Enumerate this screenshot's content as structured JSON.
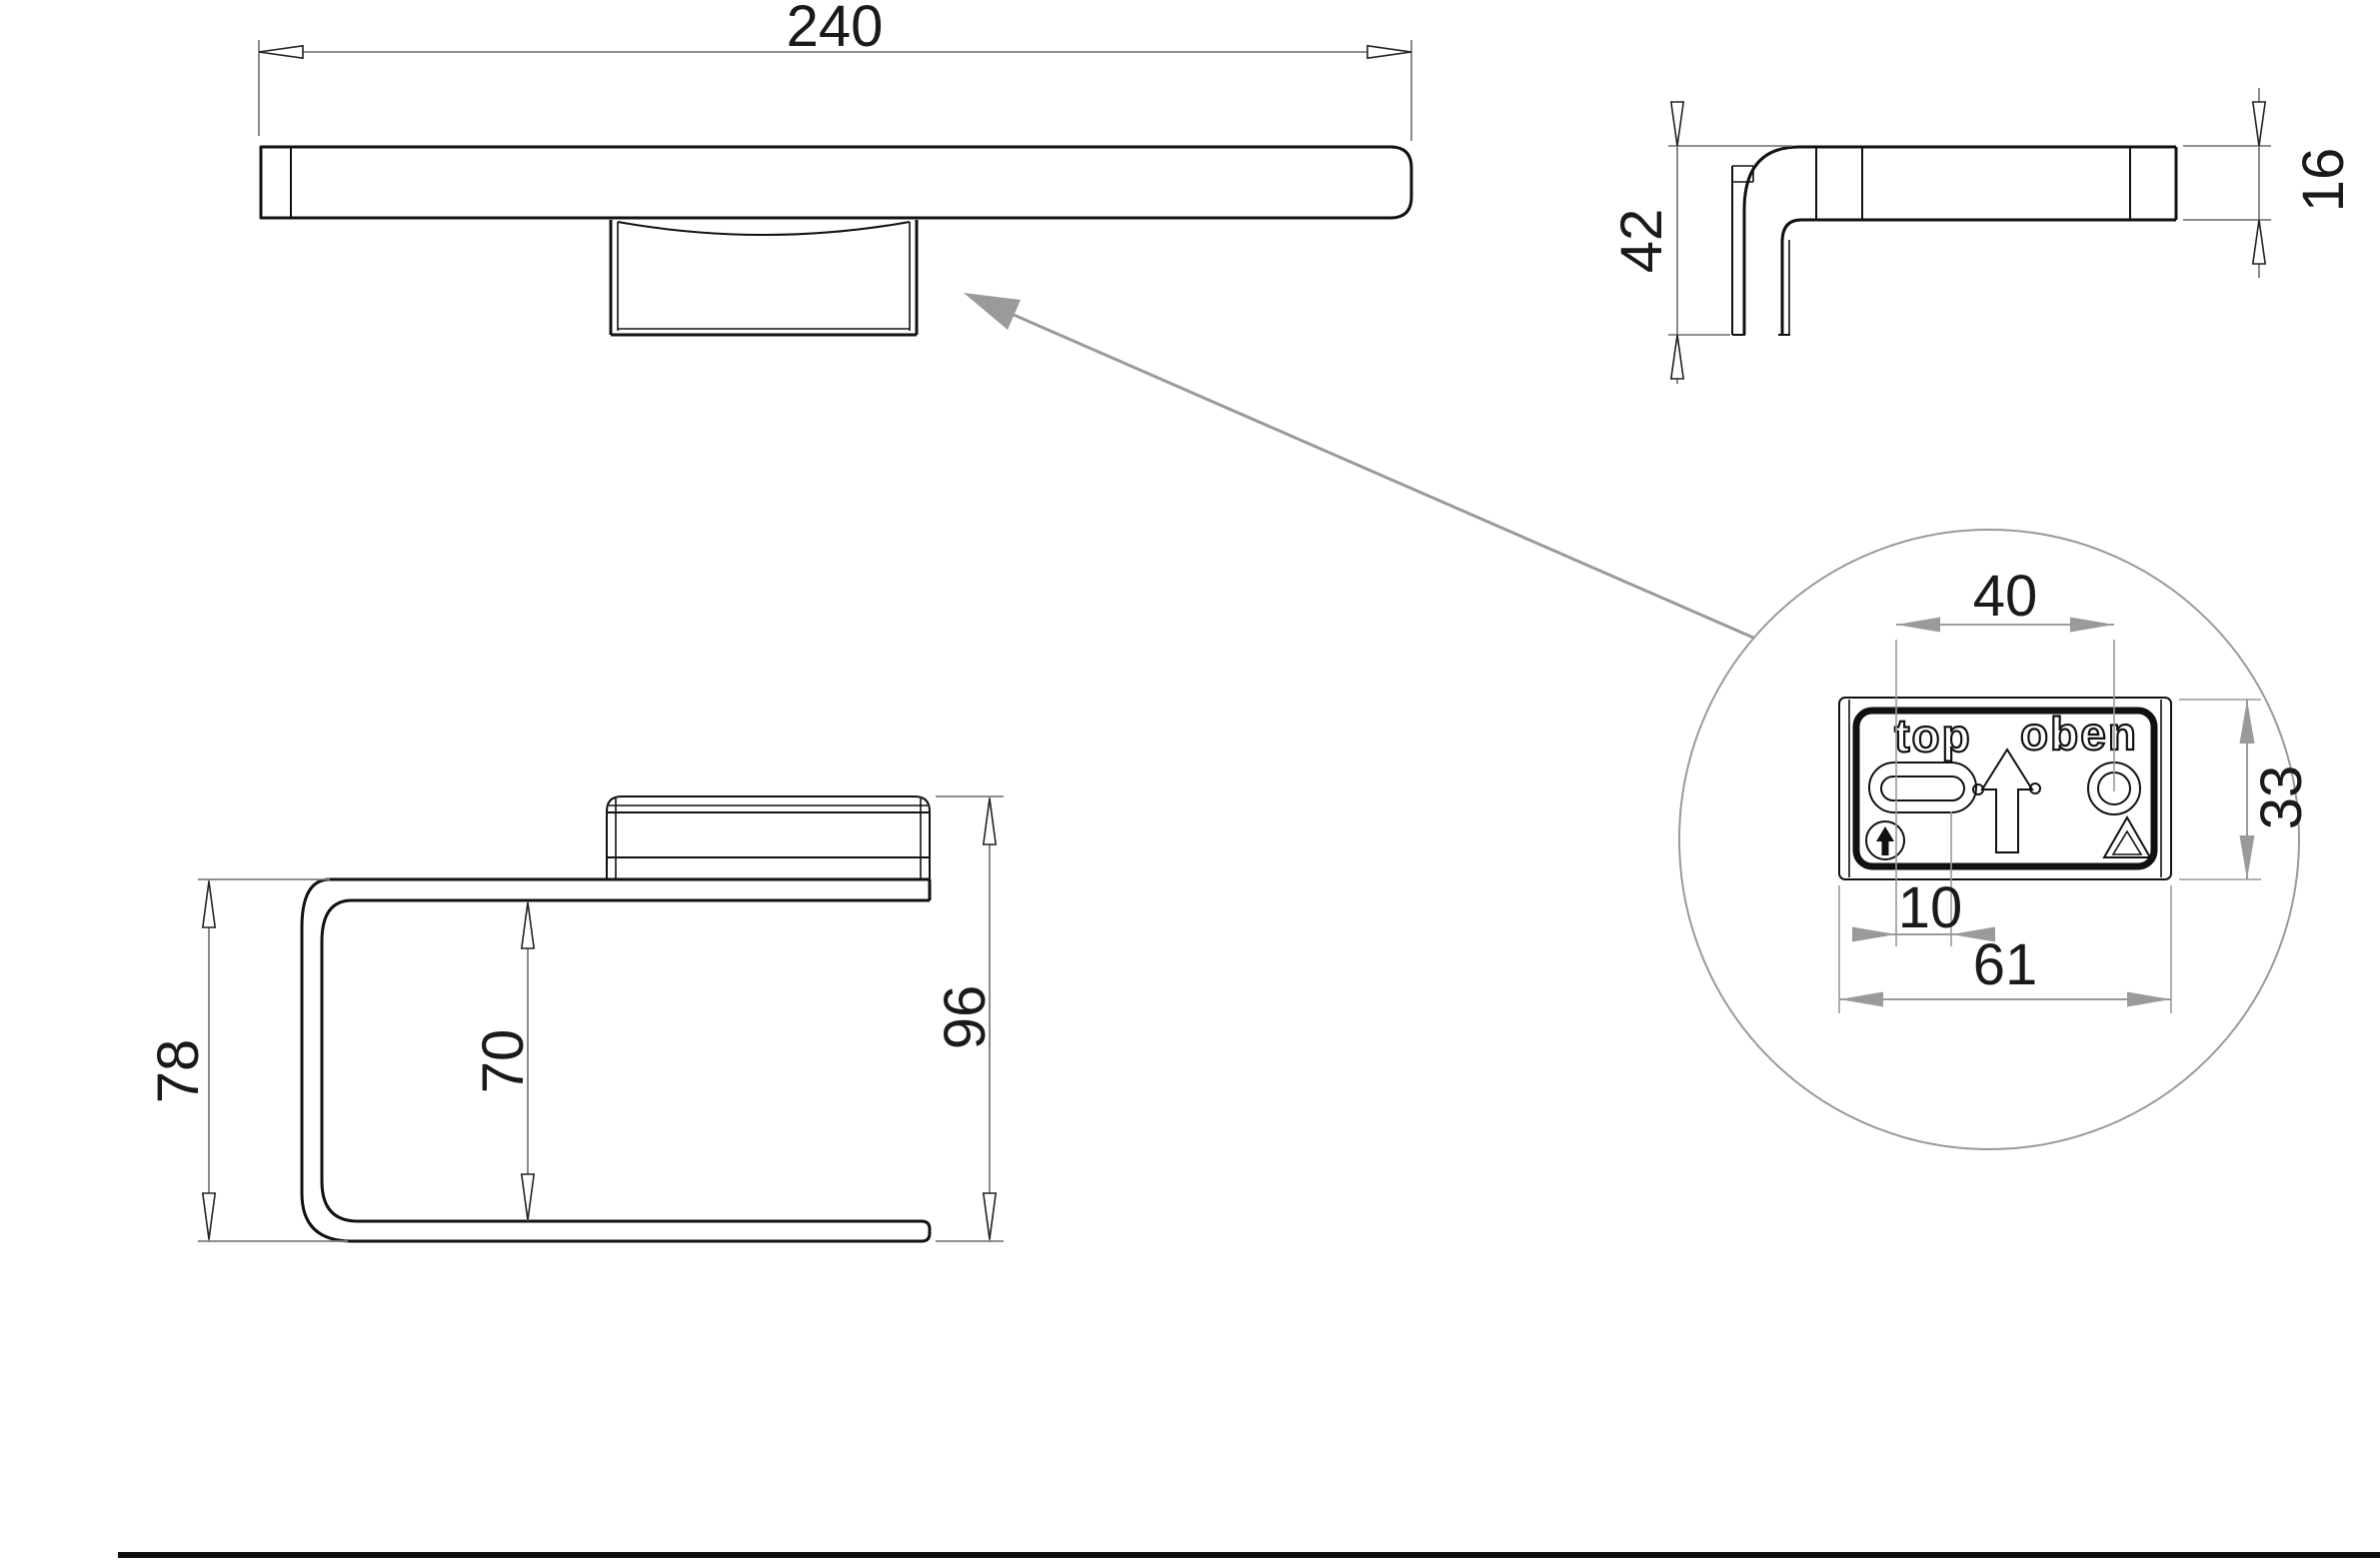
{
  "drawing_type": "technical-dimension-drawing",
  "views": {
    "plan": {
      "dims": {
        "width": "240"
      }
    },
    "side": {
      "dims": {
        "bracket_height": "42",
        "bar_thickness": "16"
      }
    },
    "front": {
      "dims": {
        "band_height": "78",
        "inner_clearance": "70",
        "overall_height": "96"
      }
    },
    "detail": {
      "plate_labels": {
        "top": "top",
        "oben": "oben"
      },
      "dims": {
        "hole_spacing": "40",
        "plate_height": "33",
        "slot_length": "10",
        "plate_width": "61"
      }
    }
  },
  "colors": {
    "ink": "#1a1a1a",
    "object_line": "#111111",
    "dimension_line": "#7e7e7e",
    "leader_gray": "#9a9a9a",
    "background": "#ffffff"
  }
}
